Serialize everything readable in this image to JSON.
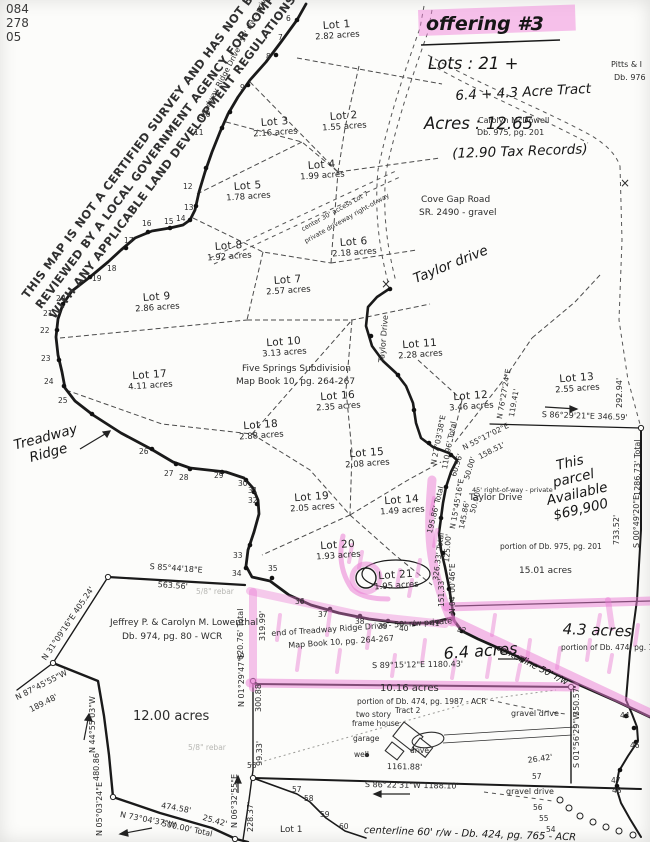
{
  "colors": {
    "highlight": "#ea7cd4",
    "ink": "#1a1a1a",
    "paper": "#fcfcfa"
  },
  "corner": {
    "l1": "084",
    "l2": "278",
    "l3": "05"
  },
  "disclaimer": {
    "l1": "THIS MAP IS NOT A CERTIFIED SURVEY AND HAS NOT BEEN",
    "l2": "REVIEWED BY A LOCAL GOVERNMENT AGENCY FOR COMPLIANCE",
    "l3": "WITH ANY APPLICABLE LAND DEVELOPMENT REGULATIONS."
  },
  "offering": {
    "title": "offering #3",
    "lots_line": "Lots : 21 +",
    "tract_line": "6.4 + 4.3 Acre Tract",
    "acres_line": "Acres : 12.65",
    "tax_line": "(12.90 Tax Records)"
  },
  "owners": {
    "mcdowell1": "Carolyn McDowell",
    "mcdowell2": "Db. 975, pg. 201",
    "pitts1": "Pitts & I",
    "pitts2": "Db. 976",
    "low1": "Jeffrey P. & Carolyn M. Lowenthal",
    "low2": "Db. 974, pg. 80 - WCR"
  },
  "subdivision": {
    "name": "Five Springs Subdivision",
    "book": "Map Book 10, pg. 264-267"
  },
  "roads": {
    "treadway_label": "Treadway Ridge Drive - 50' r/w - private",
    "cove1": "Cove Gap Road",
    "cove2": "SR. 2490 - gravel",
    "taylor_hand": "Taylor drive",
    "taylor_along": "Taylor Drive",
    "taylor_rw": "45' right-of-way - private",
    "end1": "end of Treadway Ridge Drive - 50' r/w  private",
    "end2": "Map Book 10, pg. 264-267",
    "center50": "centerline 50' r/w",
    "center60": "centerline 60' r/w - Db. 424, pg. 765 - ACR",
    "gravel": "gravel drive",
    "access1": "center 30' access Lot 7",
    "access2": "private driveway right-of-way",
    "tread_hand1": "Treadway",
    "tread_hand2": "Ridge"
  },
  "lots": [
    {
      "name": "Lot 1",
      "acres": "2.82 acres"
    },
    {
      "name": "Lot 2",
      "acres": "1.55 acres"
    },
    {
      "name": "Lot 3",
      "acres": "2.16 acres"
    },
    {
      "name": "Lot 4",
      "acres": "1.99 acres"
    },
    {
      "name": "Lot 5",
      "acres": "1.78 acres"
    },
    {
      "name": "Lot 6",
      "acres": "2.18 acres"
    },
    {
      "name": "Lot 7",
      "acres": "2.57 acres"
    },
    {
      "name": "Lot 8",
      "acres": "1.92 acres"
    },
    {
      "name": "Lot 9",
      "acres": "2.86 acres"
    },
    {
      "name": "Lot 10",
      "acres": "3.13 acres"
    },
    {
      "name": "Lot 11",
      "acres": "2.28 acres"
    },
    {
      "name": "Lot 12",
      "acres": "3.46 acres"
    },
    {
      "name": "Lot 13",
      "acres": "2.55 acres"
    },
    {
      "name": "Lot 14",
      "acres": "1.49 acres"
    },
    {
      "name": "Lot 15",
      "acres": "2.08 acres"
    },
    {
      "name": "Lot 16",
      "acres": "2.35 acres"
    },
    {
      "name": "Lot 17",
      "acres": "4.11 acres"
    },
    {
      "name": "Lot 18",
      "acres": "2.88 acres"
    },
    {
      "name": "Lot 19",
      "acres": "2.05 acres"
    },
    {
      "name": "Lot 20",
      "acres": "1.93 acres"
    },
    {
      "name": "Lot 21",
      "acres": "1.95 acres"
    }
  ],
  "parcels": {
    "avail1": "This",
    "avail2": "parcel",
    "avail3": "Available",
    "avail4": "$69,900",
    "p15_acres": "15.01 acres",
    "p15_note": "portion of Db. 975, pg. 201",
    "p43_acres": "4.3 acres",
    "p43_note": "portion of Db. 474, pg. 150",
    "p64_acres": "6.4 acres",
    "p1016_acres": "10.16 acres",
    "p1016_note": "portion of Db. 474, pg. 1987 - ACR",
    "p1016_tract": "Tract 2",
    "p12_acres": "12.00 acres",
    "lot1_south": "Lot 1"
  },
  "site": {
    "house1": "two story",
    "house2": "frame house",
    "garage": "garage",
    "well": "well",
    "drive": "drive",
    "rebar": "5/8\" rebar"
  },
  "marks": {
    "cross": "×"
  },
  "bearings": [
    "S 85°44'18\"E",
    "563.56'",
    "N 31°09'16\"E  405.24'",
    "N 87°45'55\"W",
    "189.48'",
    "N 44°55'03\"W",
    "480.86'",
    "N 05°03'24\"E",
    "N 73°04'37\"W",
    "474.58'",
    "500.00' Total",
    "25.42'",
    "N 06°32'55\"E",
    "228.37'",
    "319.99'",
    "620.76' Total",
    "N 01°29'47\"E",
    "300.88'",
    "99.33'",
    "S 89°15'12\"E   1180.43'",
    "S 86°22'31\"W   1188.10'",
    "1161.88'",
    "S 86°29'21\"E   346.59'",
    "292.94'",
    "N 76°27'24\"E",
    "119.41'",
    "N 55°17'02\"E",
    "158.51'",
    "60.96'",
    "50.00'",
    "N 27°03'38\"E",
    "110.96' Total",
    "N 15°45'16\"E",
    "195.86' Total",
    "50.00'",
    "145.86'",
    "125.00'",
    "326.33' Total",
    "N 04°00'46\"E",
    "151.33'",
    "733.52'",
    "S 00°49'20\"E",
    "1286.73' Total",
    "350.57'",
    "S 01°56'29\"W",
    "26.42'"
  ],
  "stations": {
    "n6": "6",
    "n7": "7",
    "n8": "8",
    "n9": "9",
    "n10": "10",
    "n11": "11",
    "n12": "12",
    "n13": "13",
    "n14": "14",
    "n15": "15",
    "n16": "16",
    "n17": "17",
    "n18": "18",
    "n19": "19",
    "n20": "20",
    "n21": "21",
    "n22": "22",
    "n23": "23",
    "n24": "24",
    "n25": "25",
    "n26": "26",
    "n27": "27",
    "n28": "28",
    "n29": "29",
    "n30": "30",
    "n31": "31",
    "n32": "32",
    "n33": "33",
    "n34": "34",
    "n35": "35",
    "n36": "36",
    "n37": "37",
    "n38": "38",
    "n39": "39",
    "n40": "40",
    "n41": "41",
    "n42": "42",
    "n44": "44",
    "n46": "46",
    "n47": "47",
    "n48": "48",
    "n54": "54",
    "n55": "55",
    "n56": "56",
    "n57": "57",
    "n58": "58",
    "n59": "59",
    "n60": "60"
  }
}
